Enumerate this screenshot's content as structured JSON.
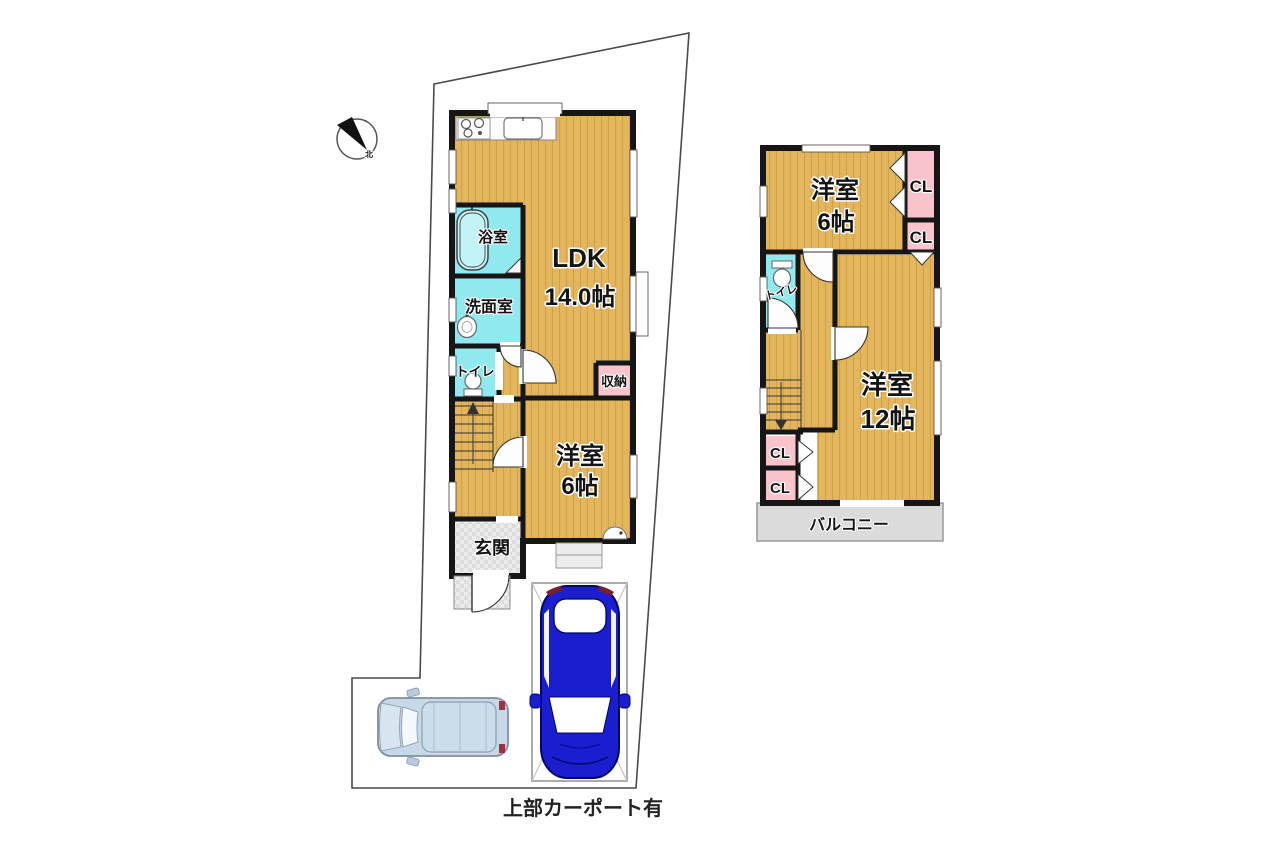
{
  "caption": "上部カーポート有",
  "compass": {
    "north_label": "北"
  },
  "floor1": {
    "ldk_name": "LDK",
    "ldk_size": "14.0帖",
    "bath": "浴室",
    "washroom": "洗面室",
    "toilet": "トイレ",
    "storage": "収納",
    "bedroom_name": "洋室",
    "bedroom_size": "6帖",
    "entrance": "玄関"
  },
  "floor2": {
    "bedroom6_name": "洋室",
    "bedroom6_size": "6帖",
    "closet_top": "CL",
    "closet_mid": "CL",
    "toilet": "トイレ",
    "bedroom12_name": "洋室",
    "bedroom12_size": "12帖",
    "closet_l1": "CL",
    "closet_l2": "CL",
    "balcony": "バルコニー"
  },
  "colors": {
    "wood": "#E3B55C",
    "wood_stripe": "#C79B45",
    "water": "#8FE9EF",
    "closet_pink": "#F8C3CB",
    "entry_gray": "#DDDDDD",
    "balcony_gray": "#DBDBDB",
    "wall": "#161616",
    "car_blue": "#1A1ECF",
    "van_blue": "#C7D9E9"
  }
}
